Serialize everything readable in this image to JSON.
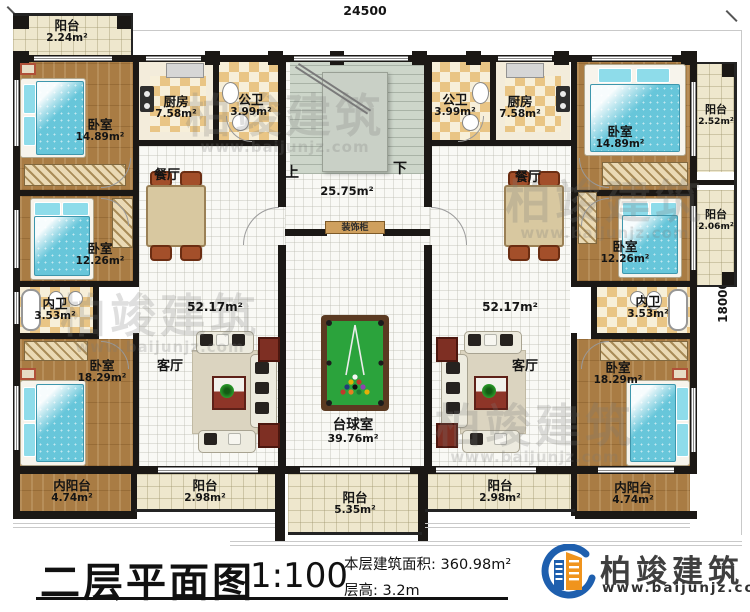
{
  "dims": {
    "top": "24500",
    "right": "18000"
  },
  "rooms": {
    "balc_tl": {
      "name": "阳台",
      "area": "2.24m²"
    },
    "bed1L": {
      "name": "卧室",
      "area": "14.89m²"
    },
    "kitchenL": {
      "name": "厨房",
      "area": "7.58m²"
    },
    "pubL": {
      "name": "公卫",
      "area": "3.99m²"
    },
    "diningL": {
      "name": "餐厅"
    },
    "bed2L": {
      "name": "卧室",
      "area": "12.26m²"
    },
    "privL": {
      "name": "内卫",
      "area": "3.53m²"
    },
    "bed3L": {
      "name": "卧室",
      "area": "18.29m²"
    },
    "livingL": {
      "name": "客厅",
      "area": "52.17m²"
    },
    "ibalcL": {
      "name": "内阳台",
      "area": "4.74m²"
    },
    "balcBL": {
      "name": "阳台",
      "area": "2.98m²"
    },
    "hall": {
      "area": "25.75m²",
      "up": "上",
      "down": "下"
    },
    "cabinet": {
      "name": "装饰柜"
    },
    "billiard": {
      "name": "台球室",
      "area": "39.76m²"
    },
    "balcC": {
      "name": "阳台",
      "area": "5.35m²"
    },
    "pubR": {
      "name": "公卫",
      "area": "3.99m²"
    },
    "kitchenR": {
      "name": "厨房",
      "area": "7.58m²"
    },
    "bed1R": {
      "name": "卧室",
      "area": "14.89m²"
    },
    "balcR1": {
      "name": "阳台",
      "area": "2.52m²"
    },
    "diningR": {
      "name": "餐厅"
    },
    "bed2R": {
      "name": "卧室",
      "area": "12.26m²"
    },
    "balcR2": {
      "name": "阳台",
      "area": "2.06m²"
    },
    "privR": {
      "name": "内卫",
      "area": "3.53m²"
    },
    "bed3R": {
      "name": "卧室",
      "area": "18.29m²"
    },
    "livingR": {
      "name": "客厅",
      "area": "52.17m²"
    },
    "ibalcR": {
      "name": "内阳台",
      "area": "4.74m²"
    },
    "balcBR": {
      "name": "阳台",
      "area": "2.98m²"
    }
  },
  "title_block": {
    "title": "二层平面图",
    "scale": "1:100",
    "floor_area": "本层建筑面积: 360.98m²",
    "floor_height": "层高: 3.2m"
  },
  "logo": {
    "brand": "柏竣建筑",
    "url": "www.baijunjz.com"
  },
  "watermark": {
    "brand": "柏竣建筑",
    "url": "www.baijunjz.com"
  },
  "colors": {
    "wall": "#1b1815",
    "wood": "#a97c44",
    "bed": "#67c6da",
    "pool_felt": "#2ba33c",
    "checker": "#e9c585",
    "logo_blue": "#1e5fae",
    "logo_orange": "#f0941d"
  }
}
